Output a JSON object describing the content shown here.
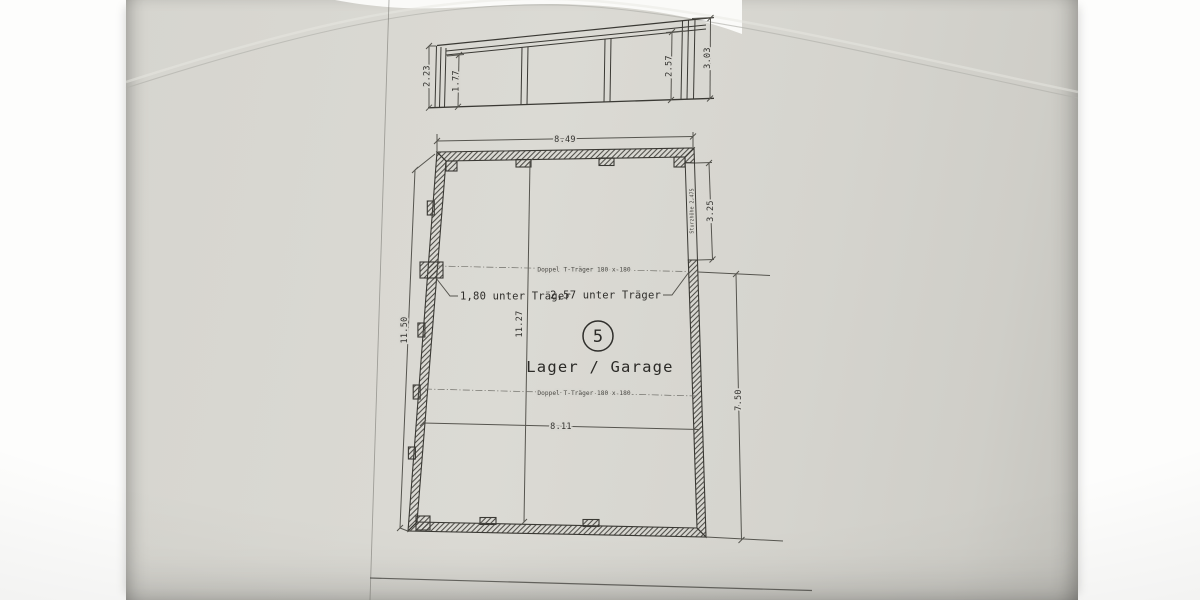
{
  "photo": {
    "paper_color": "#d8d7d1",
    "ink_color": "#3a3934",
    "description": "photographed architectural drawing sheet"
  },
  "elevation": {
    "dims": {
      "left": "2.23",
      "inner_left": "1.77",
      "inner_right": "2.57",
      "right": "3.03"
    }
  },
  "plan": {
    "dims": {
      "top": "8.49",
      "left": "11.50",
      "interior_height": "11.27",
      "opening": "3.25",
      "right": "7.50",
      "interior_width": "8.11"
    },
    "labels": {
      "beam_upper": "Doppel T-Träger 180 x 180",
      "beam_lower": "Doppel T-Träger 180 x 180",
      "clearance_left": "1,80 unter Träger",
      "clearance_right": "2,57 unter Träger",
      "lintel": "Sturzhöhe 2,475",
      "room_number": "5",
      "room_name": "Lager / Garage"
    }
  }
}
